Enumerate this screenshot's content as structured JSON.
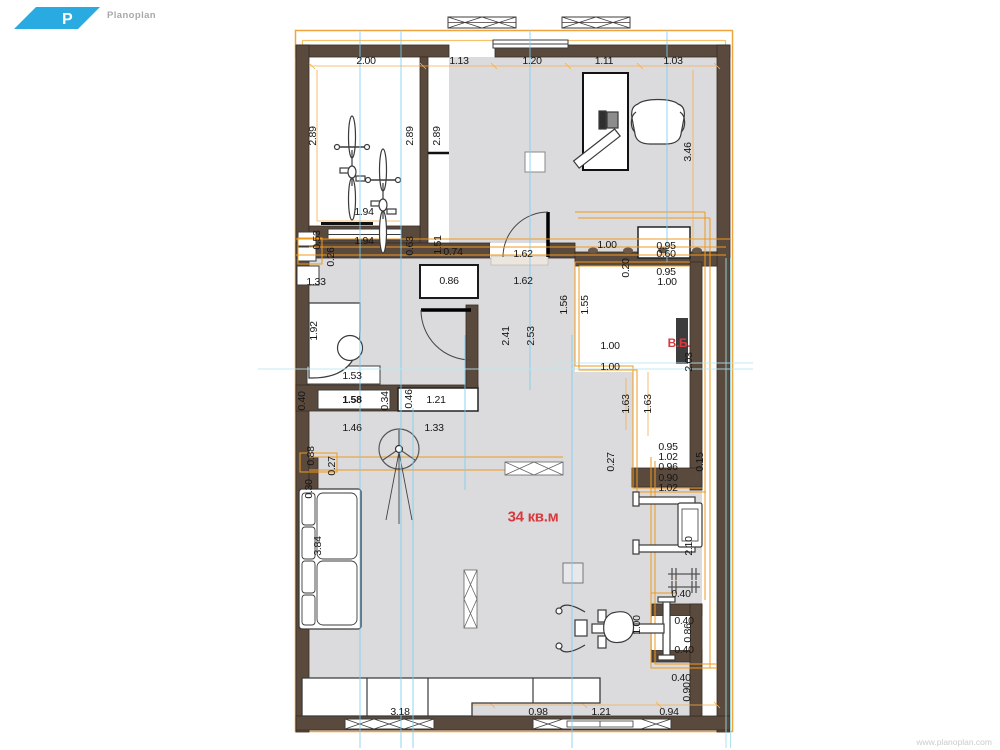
{
  "app": {
    "logo": {
      "letter": "P",
      "name": "Planoplan"
    },
    "watermark": "www.planoplan.com"
  },
  "colors": {
    "wall_brown": "#5a4a3d",
    "wall_outline": "#362b22",
    "floor_gray": "#dbdbdd",
    "wiring_orange": "#ef9a1f",
    "dimension_orange": "#f3ae4e",
    "guide_blue": "#7ccdf2",
    "guide_cyan": "#b9e7f1",
    "accent_red": "#d8393c",
    "logo_blue": "#29abe2",
    "furniture_outline": "#3a3a3a"
  },
  "plan": {
    "labels": [
      {
        "t": "2.00",
        "x": 366,
        "y": 61
      },
      {
        "t": "1.13",
        "x": 459,
        "y": 61
      },
      {
        "t": "1.20",
        "x": 532,
        "y": 61
      },
      {
        "t": "1.11",
        "x": 604,
        "y": 61
      },
      {
        "t": "1.03",
        "x": 673,
        "y": 61
      },
      {
        "t": "2.89",
        "x": 313,
        "y": 136,
        "r": 1
      },
      {
        "t": "2.89",
        "x": 410,
        "y": 136,
        "r": 1
      },
      {
        "t": "2.89",
        "x": 437,
        "y": 136,
        "r": 1
      },
      {
        "t": "3.46",
        "x": 688,
        "y": 152,
        "r": 1
      },
      {
        "t": "1.94",
        "x": 364,
        "y": 212
      },
      {
        "t": "1.94",
        "x": 364,
        "y": 241
      },
      {
        "t": "0.53",
        "x": 317,
        "y": 240,
        "r": 1
      },
      {
        "t": "0.26",
        "x": 331,
        "y": 257,
        "r": 1
      },
      {
        "t": "0.63",
        "x": 410,
        "y": 246,
        "r": 1
      },
      {
        "t": "1.51",
        "x": 438,
        "y": 245,
        "r": 1
      },
      {
        "t": "0.74",
        "x": 453,
        "y": 252
      },
      {
        "t": "0.86",
        "x": 449,
        "y": 281
      },
      {
        "t": "1.62",
        "x": 523,
        "y": 254
      },
      {
        "t": "1.62",
        "x": 523,
        "y": 281
      },
      {
        "t": "1.00",
        "x": 607,
        "y": 245
      },
      {
        "t": "0.95",
        "x": 666,
        "y": 246
      },
      {
        "t": "0.60",
        "x": 666,
        "y": 254
      },
      {
        "t": "0.20",
        "x": 626,
        "y": 268,
        "r": 1
      },
      {
        "t": "0.95",
        "x": 666,
        "y": 272
      },
      {
        "t": "1.00",
        "x": 667,
        "y": 282
      },
      {
        "t": "1.33",
        "x": 316,
        "y": 282
      },
      {
        "t": "1.92",
        "x": 314,
        "y": 331,
        "r": 1
      },
      {
        "t": "2.41",
        "x": 506,
        "y": 336,
        "r": 1
      },
      {
        "t": "2.53",
        "x": 531,
        "y": 336,
        "r": 1
      },
      {
        "t": "1.56",
        "x": 564,
        "y": 305,
        "r": 1
      },
      {
        "t": "1.55",
        "x": 585,
        "y": 305,
        "r": 1
      },
      {
        "t": "1.00",
        "x": 610,
        "y": 346
      },
      {
        "t": "В.Б.",
        "x": 679,
        "y": 343,
        "c": "red",
        "n": "room-label"
      },
      {
        "t": "2.03",
        "x": 689,
        "y": 362,
        "r": 1
      },
      {
        "t": "1.00",
        "x": 610,
        "y": 367
      },
      {
        "t": "1.53",
        "x": 352,
        "y": 376
      },
      {
        "t": "0.40",
        "x": 302,
        "y": 401,
        "r": 1
      },
      {
        "t": "1.58",
        "x": 352,
        "y": 400,
        "c": "bold"
      },
      {
        "t": "0.34",
        "x": 385,
        "y": 401,
        "r": 1
      },
      {
        "t": "0.46",
        "x": 409,
        "y": 399,
        "r": 1
      },
      {
        "t": "1.21",
        "x": 436,
        "y": 400
      },
      {
        "t": "1.63",
        "x": 626,
        "y": 404,
        "r": 1
      },
      {
        "t": "1.63",
        "x": 648,
        "y": 404,
        "r": 1
      },
      {
        "t": "1.46",
        "x": 352,
        "y": 428
      },
      {
        "t": "1.33",
        "x": 434,
        "y": 428
      },
      {
        "t": "0.88",
        "x": 311,
        "y": 456,
        "r": 1
      },
      {
        "t": "0.27",
        "x": 332,
        "y": 466,
        "r": 1
      },
      {
        "t": "0.30",
        "x": 309,
        "y": 489,
        "r": 1
      },
      {
        "t": "3.84",
        "x": 318,
        "y": 546,
        "r": 1
      },
      {
        "t": "34 кв.м",
        "x": 533,
        "y": 517,
        "c": "red-lg",
        "n": "area-label"
      },
      {
        "t": "0.95",
        "x": 668,
        "y": 447
      },
      {
        "t": "1.02",
        "x": 668,
        "y": 457
      },
      {
        "t": "0.96",
        "x": 668,
        "y": 467
      },
      {
        "t": "0.27",
        "x": 611,
        "y": 462,
        "r": 1
      },
      {
        "t": "0.90",
        "x": 668,
        "y": 478
      },
      {
        "t": "1.02",
        "x": 668,
        "y": 488
      },
      {
        "t": "0.15",
        "x": 700,
        "y": 462,
        "r": 1
      },
      {
        "t": "2.10",
        "x": 689,
        "y": 546,
        "r": 1
      },
      {
        "t": "0.40",
        "x": 681,
        "y": 594
      },
      {
        "t": "1.00",
        "x": 637,
        "y": 625,
        "r": 1
      },
      {
        "t": "0.40",
        "x": 684,
        "y": 621
      },
      {
        "t": "0.86",
        "x": 688,
        "y": 633,
        "r": 1
      },
      {
        "t": "0.40",
        "x": 684,
        "y": 650
      },
      {
        "t": "0.40",
        "x": 681,
        "y": 678
      },
      {
        "t": "0.90",
        "x": 687,
        "y": 692,
        "r": 1
      },
      {
        "t": "0.94",
        "x": 669,
        "y": 712
      },
      {
        "t": "1.21",
        "x": 601,
        "y": 712
      },
      {
        "t": "0.98",
        "x": 538,
        "y": 712
      },
      {
        "t": "3.18",
        "x": 400,
        "y": 712
      }
    ]
  }
}
